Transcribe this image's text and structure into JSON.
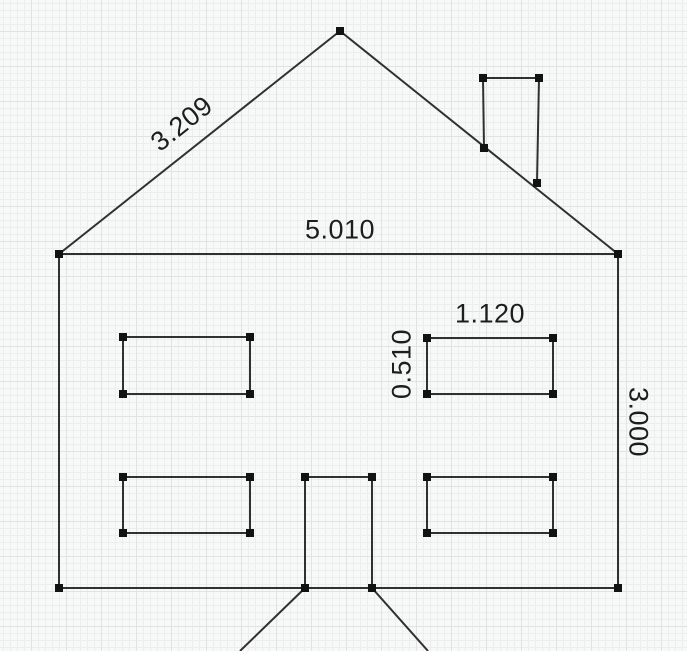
{
  "app": {
    "view": "sketch-canvas",
    "canvas_width": 687,
    "canvas_height": 651
  },
  "style": {
    "background_color": "#f7f8f8",
    "grid_minor_color": "#ededed",
    "grid_major_color": "#e2e2e2",
    "line_color": "#303030",
    "line_width": 2,
    "handle_color": "#121212",
    "handle_size": 8,
    "label_color": "#1d1d1d"
  },
  "drawing": {
    "subject": "house-elevation-sketch",
    "segments": [
      {
        "name": "roof-left-edge",
        "x1": 59,
        "y1": 254,
        "x2": 340,
        "y2": 31
      },
      {
        "name": "roof-right-edge",
        "x1": 340,
        "y1": 31,
        "x2": 618,
        "y2": 254
      },
      {
        "name": "eave-line",
        "x1": 59,
        "y1": 254,
        "x2": 618,
        "y2": 254
      },
      {
        "name": "wall-left",
        "x1": 59,
        "y1": 254,
        "x2": 59,
        "y2": 588
      },
      {
        "name": "wall-right",
        "x1": 618,
        "y1": 254,
        "x2": 618,
        "y2": 588
      },
      {
        "name": "floor-line",
        "x1": 59,
        "y1": 588,
        "x2": 618,
        "y2": 588
      },
      {
        "name": "chimney-top",
        "x1": 483,
        "y1": 78,
        "x2": 539,
        "y2": 78
      },
      {
        "name": "chimney-left",
        "x1": 483,
        "y1": 78,
        "x2": 484,
        "y2": 148
      },
      {
        "name": "chimney-right",
        "x1": 539,
        "y1": 78,
        "x2": 537,
        "y2": 183
      },
      {
        "name": "door-top",
        "x1": 305,
        "y1": 477,
        "x2": 372,
        "y2": 477
      },
      {
        "name": "door-left",
        "x1": 305,
        "y1": 477,
        "x2": 305,
        "y2": 588
      },
      {
        "name": "door-right",
        "x1": 372,
        "y1": 477,
        "x2": 372,
        "y2": 588
      },
      {
        "name": "path-left",
        "x1": 305,
        "y1": 588,
        "x2": 240,
        "y2": 651
      },
      {
        "name": "path-right",
        "x1": 372,
        "y1": 588,
        "x2": 428,
        "y2": 651
      }
    ],
    "rectangles": [
      {
        "name": "window-top-left",
        "x": 123,
        "y": 337,
        "w": 127,
        "h": 57
      },
      {
        "name": "window-top-right",
        "x": 427,
        "y": 338,
        "w": 126,
        "h": 56
      },
      {
        "name": "window-bottom-left",
        "x": 123,
        "y": 477,
        "w": 127,
        "h": 56
      },
      {
        "name": "window-bottom-right",
        "x": 427,
        "y": 477,
        "w": 126,
        "h": 56
      }
    ],
    "vertex_handles": [
      {
        "name": "vertex-roof-apex",
        "x": 340,
        "y": 31
      },
      {
        "name": "vertex-eave-left",
        "x": 59,
        "y": 254
      },
      {
        "name": "vertex-eave-right",
        "x": 618,
        "y": 254
      },
      {
        "name": "vertex-floor-left",
        "x": 59,
        "y": 588
      },
      {
        "name": "vertex-floor-right",
        "x": 618,
        "y": 588
      },
      {
        "name": "vertex-chimney-top-left",
        "x": 483,
        "y": 78
      },
      {
        "name": "vertex-chimney-top-right",
        "x": 539,
        "y": 78
      },
      {
        "name": "vertex-chimney-base-left",
        "x": 484,
        "y": 148
      },
      {
        "name": "vertex-chimney-base-right",
        "x": 537,
        "y": 183
      },
      {
        "name": "vertex-door-top-left",
        "x": 305,
        "y": 477
      },
      {
        "name": "vertex-door-top-right",
        "x": 372,
        "y": 477
      },
      {
        "name": "vertex-door-bottom-left",
        "x": 305,
        "y": 588
      },
      {
        "name": "vertex-door-bottom-right",
        "x": 372,
        "y": 588
      }
    ]
  },
  "dimension_labels": [
    {
      "id": "roof-left-length",
      "text": "3.209",
      "x": 182,
      "y": 124,
      "rotation": -38.5
    },
    {
      "id": "eave-width",
      "text": "5.010",
      "x": 340,
      "y": 230,
      "rotation": 0
    },
    {
      "id": "window-width",
      "text": "1.120",
      "x": 490,
      "y": 314,
      "rotation": 0
    },
    {
      "id": "window-height",
      "text": "0.510",
      "x": 402,
      "y": 364,
      "rotation": -90
    },
    {
      "id": "wall-height",
      "text": "3.000",
      "x": 638,
      "y": 422,
      "rotation": 90
    }
  ]
}
